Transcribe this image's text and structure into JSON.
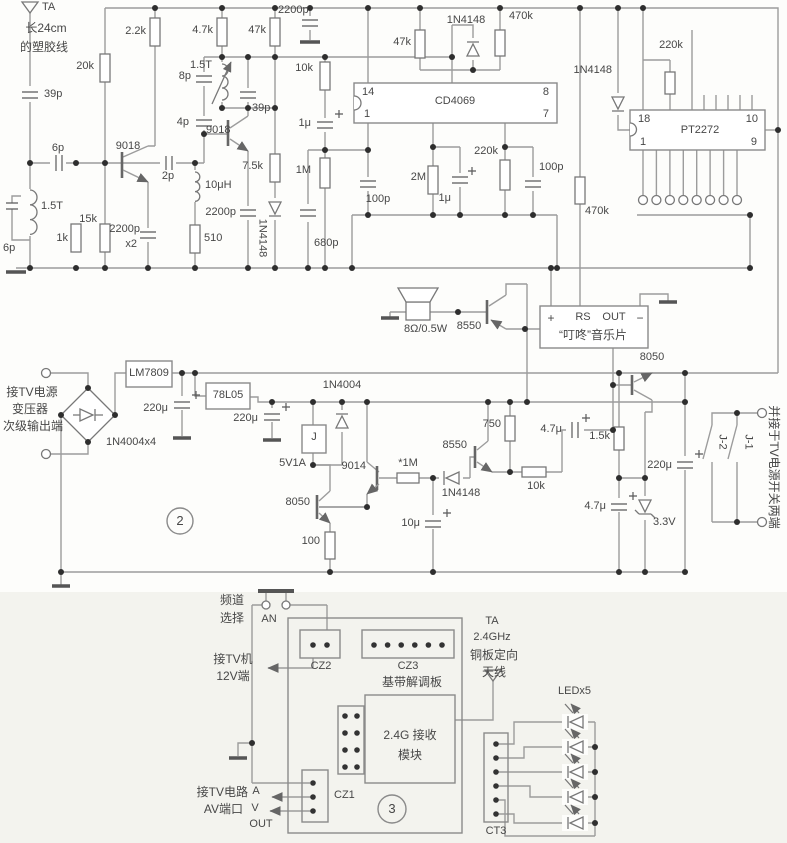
{
  "colors": {
    "wire": "#9c9c9c",
    "component": "#787878",
    "text": "#474747",
    "junction": "#2e2e2e",
    "section3_bg": "#f3f3ee"
  },
  "sections": {
    "power_section_number": "2",
    "receiver_section_number": "3"
  },
  "labels": [
    {
      "id": "ta-name",
      "t": "TA",
      "x": 42,
      "y": 2,
      "a": "l"
    },
    {
      "id": "ant-note-1",
      "t": "长24cm",
      "x": 46,
      "y": 22,
      "a": "c",
      "s": 12
    },
    {
      "id": "ant-note-2",
      "t": "的塑胶线",
      "x": 44,
      "y": 41,
      "a": "c",
      "s": 12
    },
    {
      "id": "c39p-a",
      "t": "39p",
      "x": 44,
      "y": 89,
      "a": "l"
    },
    {
      "id": "c6p-series",
      "t": "6p",
      "x": 58,
      "y": 143,
      "a": "c"
    },
    {
      "id": "l15t-a",
      "t": "1.5T",
      "x": 41,
      "y": 201,
      "a": "l"
    },
    {
      "id": "c6p-b",
      "t": "6p",
      "x": 3,
      "y": 243,
      "a": "l"
    },
    {
      "id": "r1k",
      "t": "1k",
      "x": 68,
      "y": 233,
      "a": "r"
    },
    {
      "id": "r15k",
      "t": "15k",
      "x": 97,
      "y": 214,
      "a": "r"
    },
    {
      "id": "r20k",
      "t": "20k",
      "x": 94,
      "y": 61,
      "a": "r"
    },
    {
      "id": "r2k2",
      "t": "2.2k",
      "x": 146,
      "y": 26,
      "a": "r"
    },
    {
      "id": "q1-9018",
      "t": "9018",
      "x": 128,
      "y": 141,
      "a": "c"
    },
    {
      "id": "c2p",
      "t": "2p",
      "x": 168,
      "y": 171,
      "a": "c"
    },
    {
      "id": "l10uh",
      "t": "10μH",
      "x": 205,
      "y": 180,
      "a": "l"
    },
    {
      "id": "c2200-x2a",
      "t": "2200p",
      "x": 140,
      "y": 224,
      "a": "r"
    },
    {
      "id": "c2200-x2b",
      "t": "x2",
      "x": 137,
      "y": 239,
      "a": "r"
    },
    {
      "id": "r510",
      "t": "510",
      "x": 204,
      "y": 233,
      "a": "l"
    },
    {
      "id": "c2200-b",
      "t": "2200p",
      "x": 236,
      "y": 207,
      "a": "r"
    },
    {
      "id": "r4k7",
      "t": "4.7k",
      "x": 213,
      "y": 25,
      "a": "r"
    },
    {
      "id": "r47k-a",
      "t": "47k",
      "x": 266,
      "y": 25,
      "a": "r"
    },
    {
      "id": "c2200-c",
      "t": "2200p",
      "x": 278,
      "y": 5,
      "a": "l"
    },
    {
      "id": "l15t-b",
      "t": "1.5T",
      "x": 212,
      "y": 60,
      "a": "r"
    },
    {
      "id": "c8p",
      "t": "8p",
      "x": 191,
      "y": 71,
      "a": "r"
    },
    {
      "id": "c4p",
      "t": "4p",
      "x": 189,
      "y": 117,
      "a": "r"
    },
    {
      "id": "q2-9018",
      "t": "9018",
      "x": 206,
      "y": 125,
      "a": "l"
    },
    {
      "id": "c39p-b",
      "t": "39p",
      "x": 252,
      "y": 103,
      "a": "l"
    },
    {
      "id": "r7k5",
      "t": "7.5k",
      "x": 263,
      "y": 161,
      "a": "r"
    },
    {
      "id": "d1n4148-a",
      "t": "1N4148",
      "x": 262,
      "y": 238,
      "a": "c",
      "rot": 90
    },
    {
      "id": "r10k-a",
      "t": "10k",
      "x": 313,
      "y": 63,
      "a": "r"
    },
    {
      "id": "c1u-a",
      "t": "1μ",
      "x": 311,
      "y": 118,
      "a": "r"
    },
    {
      "id": "r1m",
      "t": "1M",
      "x": 311,
      "y": 165,
      "a": "r"
    },
    {
      "id": "c680p",
      "t": "680p",
      "x": 314,
      "y": 238,
      "a": "l"
    },
    {
      "id": "ic1-name",
      "t": "CD4069",
      "x": 455,
      "y": 96,
      "a": "c"
    },
    {
      "id": "ic1-p14",
      "t": "14",
      "x": 362,
      "y": 87,
      "a": "l"
    },
    {
      "id": "ic1-p1",
      "t": "1",
      "x": 364,
      "y": 109,
      "a": "l"
    },
    {
      "id": "ic1-p8",
      "t": "8",
      "x": 549,
      "y": 87,
      "a": "r"
    },
    {
      "id": "ic1-p7",
      "t": "7",
      "x": 549,
      "y": 109,
      "a": "r"
    },
    {
      "id": "r47k-b",
      "t": "47k",
      "x": 411,
      "y": 37,
      "a": "r"
    },
    {
      "id": "d1n4148-b",
      "t": "1N4148",
      "x": 466,
      "y": 15,
      "a": "c"
    },
    {
      "id": "r470k-a",
      "t": "470k",
      "x": 509,
      "y": 11,
      "a": "l"
    },
    {
      "id": "c100p-a",
      "t": "100p",
      "x": 378,
      "y": 194,
      "a": "c"
    },
    {
      "id": "r2m",
      "t": "2M",
      "x": 426,
      "y": 172,
      "a": "r"
    },
    {
      "id": "c1u-b",
      "t": "1μ",
      "x": 451,
      "y": 193,
      "a": "r"
    },
    {
      "id": "r220k-a",
      "t": "220k",
      "x": 498,
      "y": 146,
      "a": "r"
    },
    {
      "id": "c100p-b",
      "t": "100p",
      "x": 539,
      "y": 162,
      "a": "l"
    },
    {
      "id": "d1n4148-c",
      "t": "1N4148",
      "x": 612,
      "y": 65,
      "a": "r"
    },
    {
      "id": "r470k-b",
      "t": "470k",
      "x": 585,
      "y": 206,
      "a": "l"
    },
    {
      "id": "r220k-b",
      "t": "220k",
      "x": 671,
      "y": 40,
      "a": "c"
    },
    {
      "id": "ic2-name",
      "t": "PT2272",
      "x": 700,
      "y": 125,
      "a": "c"
    },
    {
      "id": "ic2-p18",
      "t": "18",
      "x": 638,
      "y": 114,
      "a": "l"
    },
    {
      "id": "ic2-p1",
      "t": "1",
      "x": 640,
      "y": 137,
      "a": "l"
    },
    {
      "id": "ic2-p10",
      "t": "10",
      "x": 758,
      "y": 114,
      "a": "r"
    },
    {
      "id": "ic2-p9",
      "t": "9",
      "x": 757,
      "y": 137,
      "a": "r"
    },
    {
      "id": "spk-value",
      "t": "8Ω/0.5W",
      "x": 404,
      "y": 324,
      "a": "l"
    },
    {
      "id": "q3-8550",
      "t": "8550",
      "x": 469,
      "y": 321,
      "a": "c"
    },
    {
      "id": "mc-plus",
      "t": "+",
      "x": 551,
      "y": 312,
      "a": "c",
      "s": 12
    },
    {
      "id": "mc-rs",
      "t": "RS",
      "x": 583,
      "y": 312,
      "a": "c"
    },
    {
      "id": "mc-out",
      "t": "OUT",
      "x": 614,
      "y": 312,
      "a": "c"
    },
    {
      "id": "mc-minus",
      "t": "−",
      "x": 640,
      "y": 312,
      "a": "c",
      "s": 12
    },
    {
      "id": "mc-name",
      "t": "“叮咚”音乐片",
      "x": 593,
      "y": 329,
      "a": "c",
      "s": 12
    },
    {
      "id": "q7-8050",
      "t": "8050",
      "x": 652,
      "y": 352,
      "a": "c"
    },
    {
      "id": "pw-note-1",
      "t": "接TV电源",
      "x": 32,
      "y": 386,
      "a": "c",
      "s": 12
    },
    {
      "id": "pw-note-2",
      "t": "变压器",
      "x": 30,
      "y": 403,
      "a": "c",
      "s": 12
    },
    {
      "id": "pw-note-3",
      "t": "次级输出端",
      "x": 33,
      "y": 420,
      "a": "c",
      "s": 12
    },
    {
      "id": "bridge-name",
      "t": "1N4004x4",
      "x": 106,
      "y": 437,
      "a": "l"
    },
    {
      "id": "reg1",
      "t": "LM7809",
      "x": 149,
      "y": 368,
      "a": "c"
    },
    {
      "id": "c220u-a",
      "t": "220μ",
      "x": 168,
      "y": 403,
      "a": "r"
    },
    {
      "id": "reg2",
      "t": "78L05",
      "x": 228,
      "y": 390,
      "a": "c"
    },
    {
      "id": "c220u-b",
      "t": "220μ",
      "x": 258,
      "y": 413,
      "a": "r"
    },
    {
      "id": "d1n4004",
      "t": "1N4004",
      "x": 342,
      "y": 380,
      "a": "c"
    },
    {
      "id": "relay-j",
      "t": "J",
      "x": 314,
      "y": 432,
      "a": "c"
    },
    {
      "id": "v5v1a",
      "t": "5V1A",
      "x": 306,
      "y": 458,
      "a": "r"
    },
    {
      "id": "q4-8050",
      "t": "8050",
      "x": 310,
      "y": 497,
      "a": "r"
    },
    {
      "id": "r100",
      "t": "100",
      "x": 320,
      "y": 536,
      "a": "r"
    },
    {
      "id": "q5-9014",
      "t": "9014",
      "x": 366,
      "y": 461,
      "a": "r"
    },
    {
      "id": "r1m-star",
      "t": "*1M",
      "x": 408,
      "y": 458,
      "a": "c"
    },
    {
      "id": "d1n4148-d",
      "t": "1N4148",
      "x": 461,
      "y": 488,
      "a": "c"
    },
    {
      "id": "q6-8550",
      "t": "8550",
      "x": 467,
      "y": 440,
      "a": "r"
    },
    {
      "id": "r750",
      "t": "750",
      "x": 501,
      "y": 419,
      "a": "r"
    },
    {
      "id": "r10k-b",
      "t": "10k",
      "x": 536,
      "y": 481,
      "a": "c"
    },
    {
      "id": "c4u7-a",
      "t": "4.7μ",
      "x": 562,
      "y": 424,
      "a": "r"
    },
    {
      "id": "c10u",
      "t": "10μ",
      "x": 420,
      "y": 518,
      "a": "r"
    },
    {
      "id": "r1k5",
      "t": "1.5k",
      "x": 610,
      "y": 431,
      "a": "r"
    },
    {
      "id": "c220u-c",
      "t": "220μ",
      "x": 672,
      "y": 460,
      "a": "r"
    },
    {
      "id": "c4u7-b",
      "t": "4.7μ",
      "x": 606,
      "y": 501,
      "a": "r"
    },
    {
      "id": "dz3v3",
      "t": "3.3V",
      "x": 653,
      "y": 517,
      "a": "l"
    },
    {
      "id": "sec2-num",
      "t": "2",
      "x": 180,
      "y": 514,
      "a": "c",
      "s": 13
    },
    {
      "id": "j1",
      "t": "J-1",
      "x": 748,
      "y": 442,
      "a": "c",
      "rot": 90
    },
    {
      "id": "j2",
      "t": "J-2",
      "x": 722,
      "y": 442,
      "a": "c",
      "rot": 90
    },
    {
      "id": "sw-note",
      "t": "并接于TV电源开关两端",
      "x": 774,
      "y": 467,
      "a": "c",
      "rot": 90,
      "s": 12
    },
    {
      "id": "ch-sel-1",
      "t": "频道",
      "x": 232,
      "y": 594,
      "a": "c",
      "s": 12
    },
    {
      "id": "ch-sel-2",
      "t": "选择",
      "x": 232,
      "y": 612,
      "a": "c",
      "s": 12
    },
    {
      "id": "an-btn",
      "t": "AN",
      "x": 269,
      "y": 614,
      "a": "c"
    },
    {
      "id": "tv12-1",
      "t": "接TV机",
      "x": 233,
      "y": 653,
      "a": "c",
      "s": 12
    },
    {
      "id": "tv12-2",
      "t": "12V端",
      "x": 233,
      "y": 670,
      "a": "c",
      "s": 12
    },
    {
      "id": "cz2",
      "t": "CZ2",
      "x": 321,
      "y": 661,
      "a": "c"
    },
    {
      "id": "cz3",
      "t": "CZ3",
      "x": 408,
      "y": 661,
      "a": "c"
    },
    {
      "id": "bb-board",
      "t": "基带解调板",
      "x": 412,
      "y": 676,
      "a": "c",
      "s": 12
    },
    {
      "id": "mod-1",
      "t": "2.4G 接收",
      "x": 410,
      "y": 729,
      "a": "c",
      "s": 12
    },
    {
      "id": "mod-2",
      "t": "模块",
      "x": 410,
      "y": 749,
      "a": "c",
      "s": 12
    },
    {
      "id": "cz1",
      "t": "CZ1",
      "x": 334,
      "y": 790,
      "a": "l"
    },
    {
      "id": "av-note-1",
      "t": "接TV电路",
      "x": 248,
      "y": 786,
      "a": "r",
      "s": 12
    },
    {
      "id": "av-a",
      "t": "A",
      "x": 256,
      "y": 786,
      "a": "c"
    },
    {
      "id": "av-note-2",
      "t": "AV端口",
      "x": 243,
      "y": 803,
      "a": "r",
      "s": 12
    },
    {
      "id": "av-v",
      "t": "V",
      "x": 255,
      "y": 803,
      "a": "c"
    },
    {
      "id": "av-out",
      "t": "OUT",
      "x": 261,
      "y": 819,
      "a": "c"
    },
    {
      "id": "sec3-num",
      "t": "3",
      "x": 392,
      "y": 802,
      "a": "c",
      "s": 13
    },
    {
      "id": "ta2-1",
      "t": "TA",
      "x": 492,
      "y": 616,
      "a": "c"
    },
    {
      "id": "ta2-2",
      "t": "2.4GHz",
      "x": 492,
      "y": 632,
      "a": "c"
    },
    {
      "id": "ta2-3",
      "t": "铜板定向",
      "x": 494,
      "y": 649,
      "a": "c",
      "s": 12
    },
    {
      "id": "ta2-4",
      "t": "天线",
      "x": 494,
      "y": 666,
      "a": "c",
      "s": 12
    },
    {
      "id": "led-name",
      "t": "LEDx5",
      "x": 558,
      "y": 686,
      "a": "l"
    },
    {
      "id": "ct3",
      "t": "CT3",
      "x": 496,
      "y": 826,
      "a": "c"
    }
  ]
}
